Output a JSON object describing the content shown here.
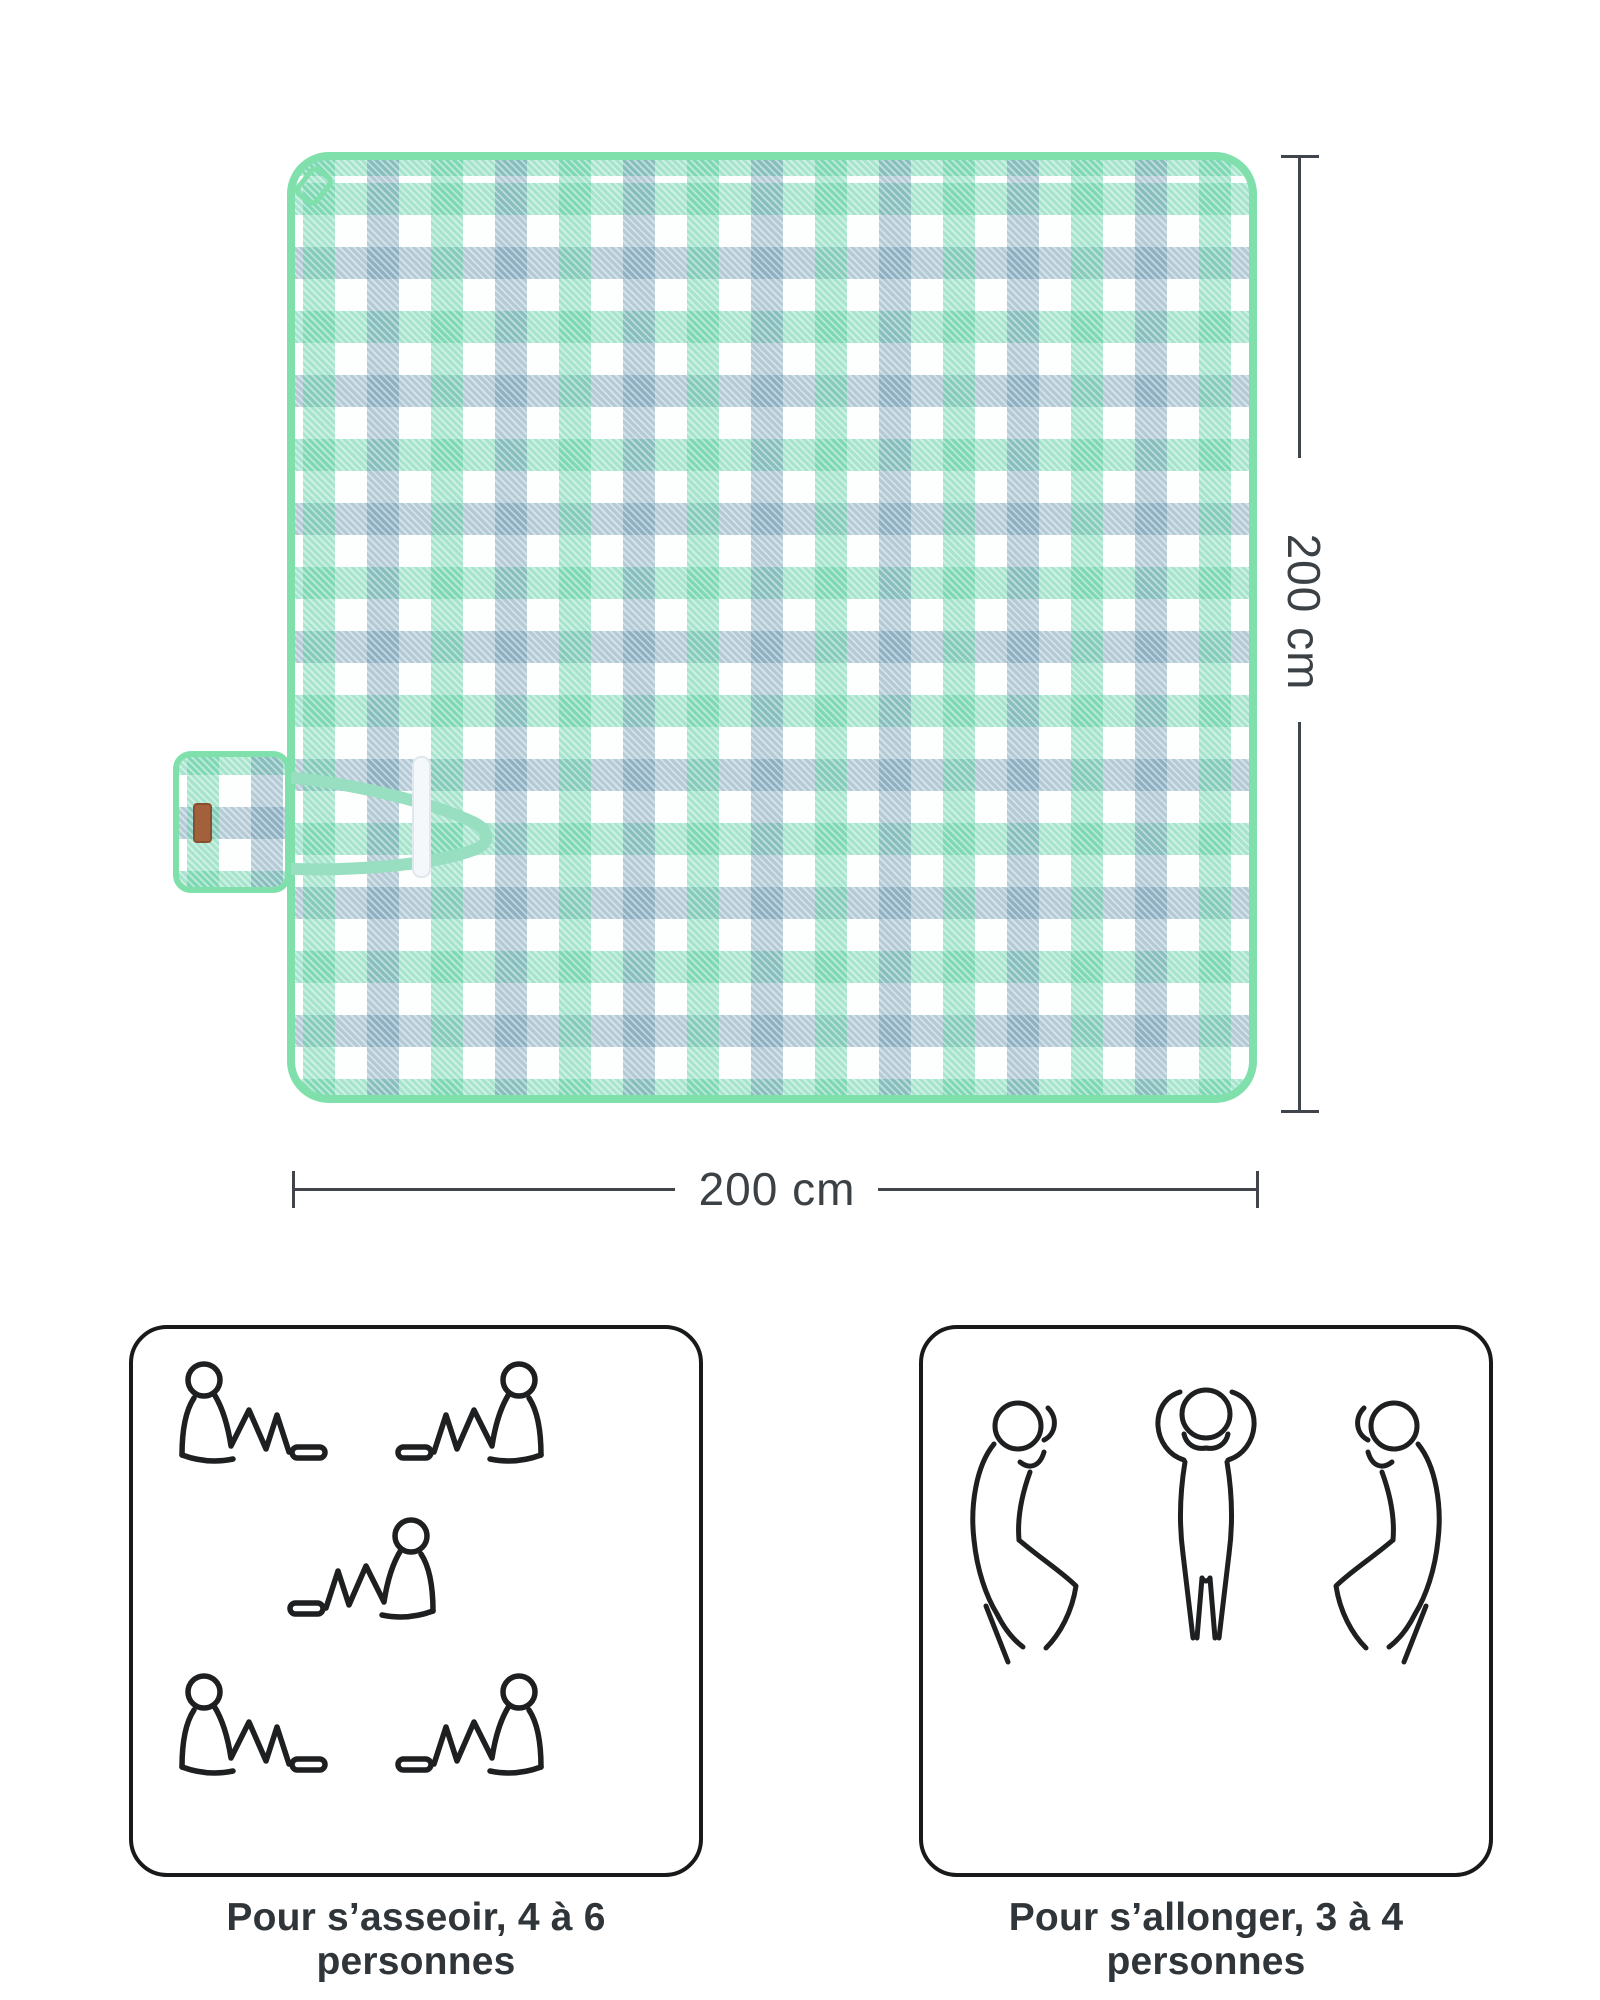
{
  "page": {
    "background": "#ffffff"
  },
  "blanket": {
    "name": "checkered picnic blanket, top view, folded flap with carry strap",
    "pattern": "gingham",
    "colors": {
      "binding": "#7fe0ab",
      "check_green": "#8fdec0",
      "check_blue": "#8ab3c3",
      "ground": "#ffffff",
      "strap": "#97dfc0",
      "velcro": "#f4f8fa",
      "leather_label": "#a2613a"
    }
  },
  "dimensions": {
    "line_color": "#3f454a",
    "height": {
      "label": "200 cm"
    },
    "width": {
      "label": "200 cm"
    }
  },
  "usage_panels": [
    {
      "id": "sitting",
      "caption": "Pour s’asseoir, 4 à 6 personnes",
      "figure_count": 5,
      "icon": "sitting-person-icon"
    },
    {
      "id": "lying",
      "caption": "Pour s’allonger, 3 à 4 personnes",
      "figure_count": 3,
      "icon": "lying-person-icon"
    }
  ]
}
